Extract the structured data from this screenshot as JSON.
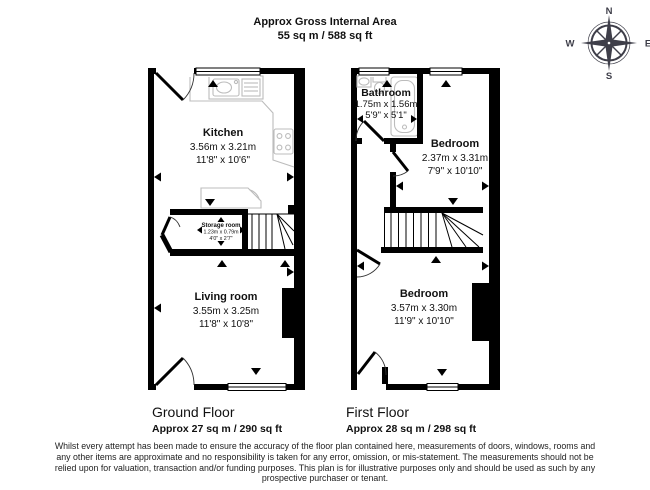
{
  "header": {
    "line1": "Approx Gross Internal Area",
    "line2": "55 sq m / 588 sq ft"
  },
  "compass": {
    "n": "N",
    "e": "E",
    "s": "S",
    "w": "W"
  },
  "ground_floor": {
    "label": "Ground Floor",
    "area": "Approx 27 sq m / 290 sq ft",
    "rooms": {
      "kitchen": {
        "name": "Kitchen",
        "metric": "3.56m x 3.21m",
        "imperial": "11'8\" x 10'6\""
      },
      "storage": {
        "name": "Storage room",
        "metric": "1.23m x 0.79m",
        "imperial": "4'0\" x 2'7\""
      },
      "living": {
        "name": "Living room",
        "metric": "3.55m x 3.25m",
        "imperial": "11'8\" x 10'8\""
      }
    }
  },
  "first_floor": {
    "label": "First Floor",
    "area": "Approx 28 sq m / 298 sq ft",
    "rooms": {
      "bathroom": {
        "name": "Bathroom",
        "metric": "1.75m x 1.56m",
        "imperial": "5'9\" x 5'1\""
      },
      "bedroom_front": {
        "name": "Bedroom",
        "metric": "2.37m x 3.31m",
        "imperial": "7'9\" x 10'10\""
      },
      "bedroom_back": {
        "name": "Bedroom",
        "metric": "3.57m x 3.30m",
        "imperial": "11'9\" x 10'10\""
      }
    }
  },
  "disclaimer": {
    "lines": [
      "Whilst every attempt has been made to ensure the accuracy of the floor plan contained here, measurements of doors, windows, rooms and",
      "any other items are approximate and no responsibility is taken for any error, omission, or mis-statement. The measurements should not be",
      "relied upon for valuation, transaction and/or funding purposes. This plan is for illustrative purposes only and should be used as such by any",
      "prospective purchaser or tenant."
    ]
  },
  "colors": {
    "wall": "#000000",
    "fixture": "#bcbcbc",
    "compass": "#3e3e49",
    "text": "#111111"
  }
}
